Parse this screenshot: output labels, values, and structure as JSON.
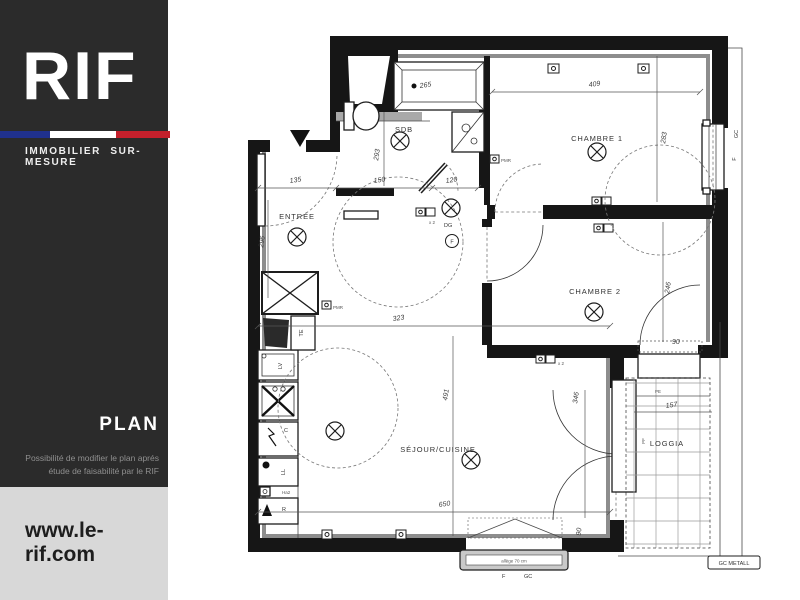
{
  "sidebar": {
    "logo": "RIF",
    "tagline": "IMMOBILIER SUR-MESURE",
    "section": "PLAN",
    "note1": "Possibilité de modifier le plan aprés",
    "note2": "étude de faisabilité par le RIF",
    "website": "www.le-rif.com",
    "colors": {
      "sidebar_bg": "#2b2b2b",
      "footer_bg": "#d8d8d8",
      "flag_blue": "#20318d",
      "flag_white": "#ffffff",
      "flag_red": "#c4202c"
    }
  },
  "plan": {
    "rooms": {
      "entree": "ENTRÉE",
      "sdb": "SDB",
      "chambre1": "CHAMBRE 1",
      "chambre2": "CHAMBRE 2",
      "sejour": "SÉJOUR/CUISINE",
      "loggia": "LOGGIA"
    },
    "dims": {
      "d135": "135",
      "d150": "150",
      "d120": "120",
      "d293": "293",
      "d296": "296",
      "d265": "265",
      "d409": "409",
      "d283": "283",
      "d323": "323",
      "d246": "246",
      "d491": "491",
      "d650": "650",
      "d346": "346",
      "d157": "157",
      "d90": "90",
      "d90b": "90"
    },
    "labels": {
      "dg": "DG",
      "f": "F",
      "x2a": "x 2",
      "x2b": "x 2",
      "pmr1": "PMR",
      "pmr2": "PMR",
      "te": "TE",
      "lv": "LV",
      "c": "C",
      "ll": "LL",
      "ha2": "Ha2",
      "r": "R",
      "pe": "PE",
      "pf": "PF",
      "gc_right": "GC",
      "f_right": "F",
      "f_bottom": "F",
      "gc_bottom": "GC",
      "gc_metal": "GC METALL",
      "allege": "allège 70 cm"
    }
  }
}
